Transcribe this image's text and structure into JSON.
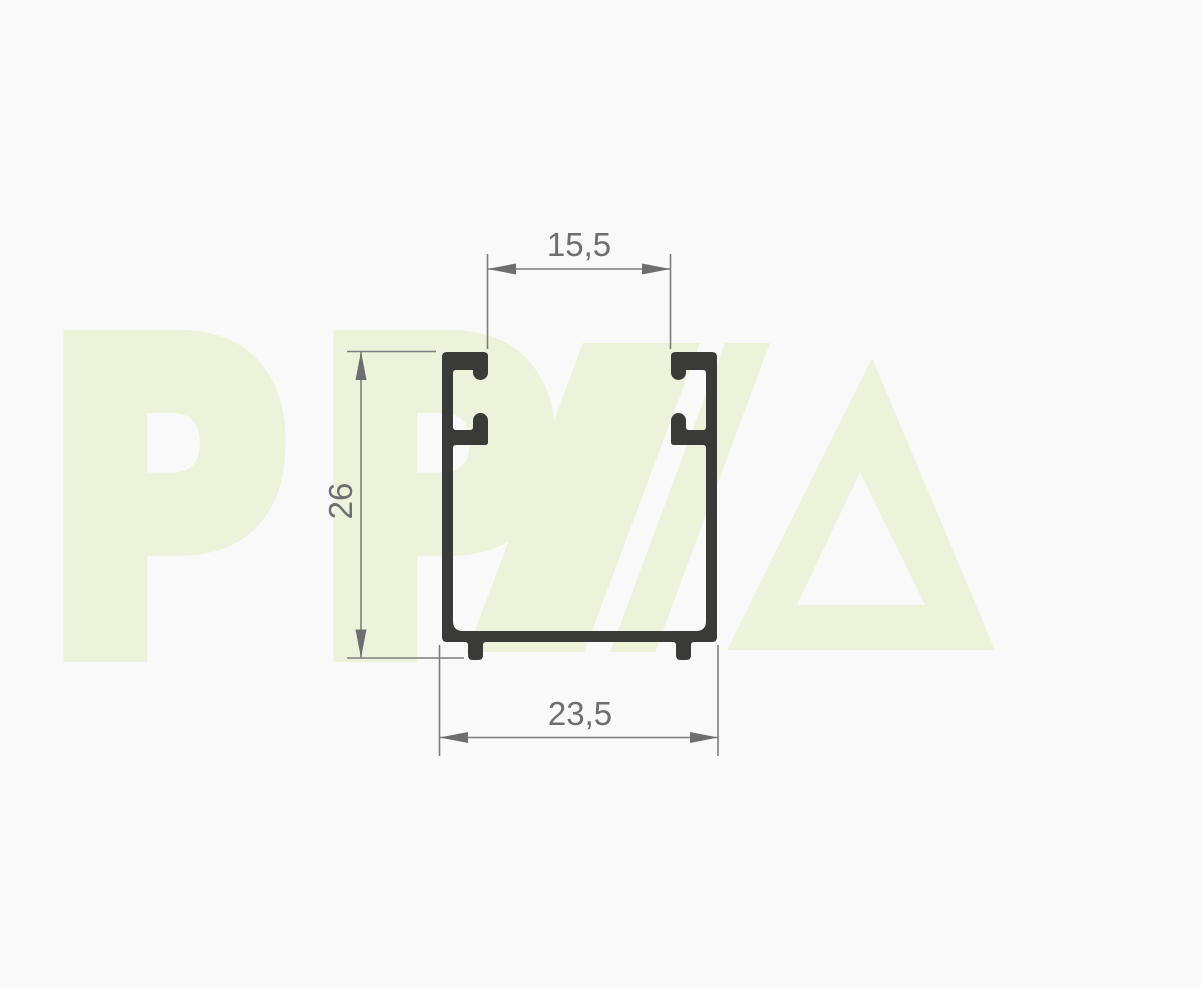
{
  "drawing": {
    "dimensions": {
      "top_width_label": "15,5",
      "height_label": "26",
      "bottom_width_label": "23,5"
    },
    "watermark": {
      "letters": "PP",
      "mark_letter": "A"
    },
    "colors": {
      "background": "#f9f9f9",
      "profile": "#3a3a38",
      "dimension_lines": "#7d7d7d",
      "dimension_text": "#6e6e6e",
      "watermark": "#edf2da"
    }
  }
}
